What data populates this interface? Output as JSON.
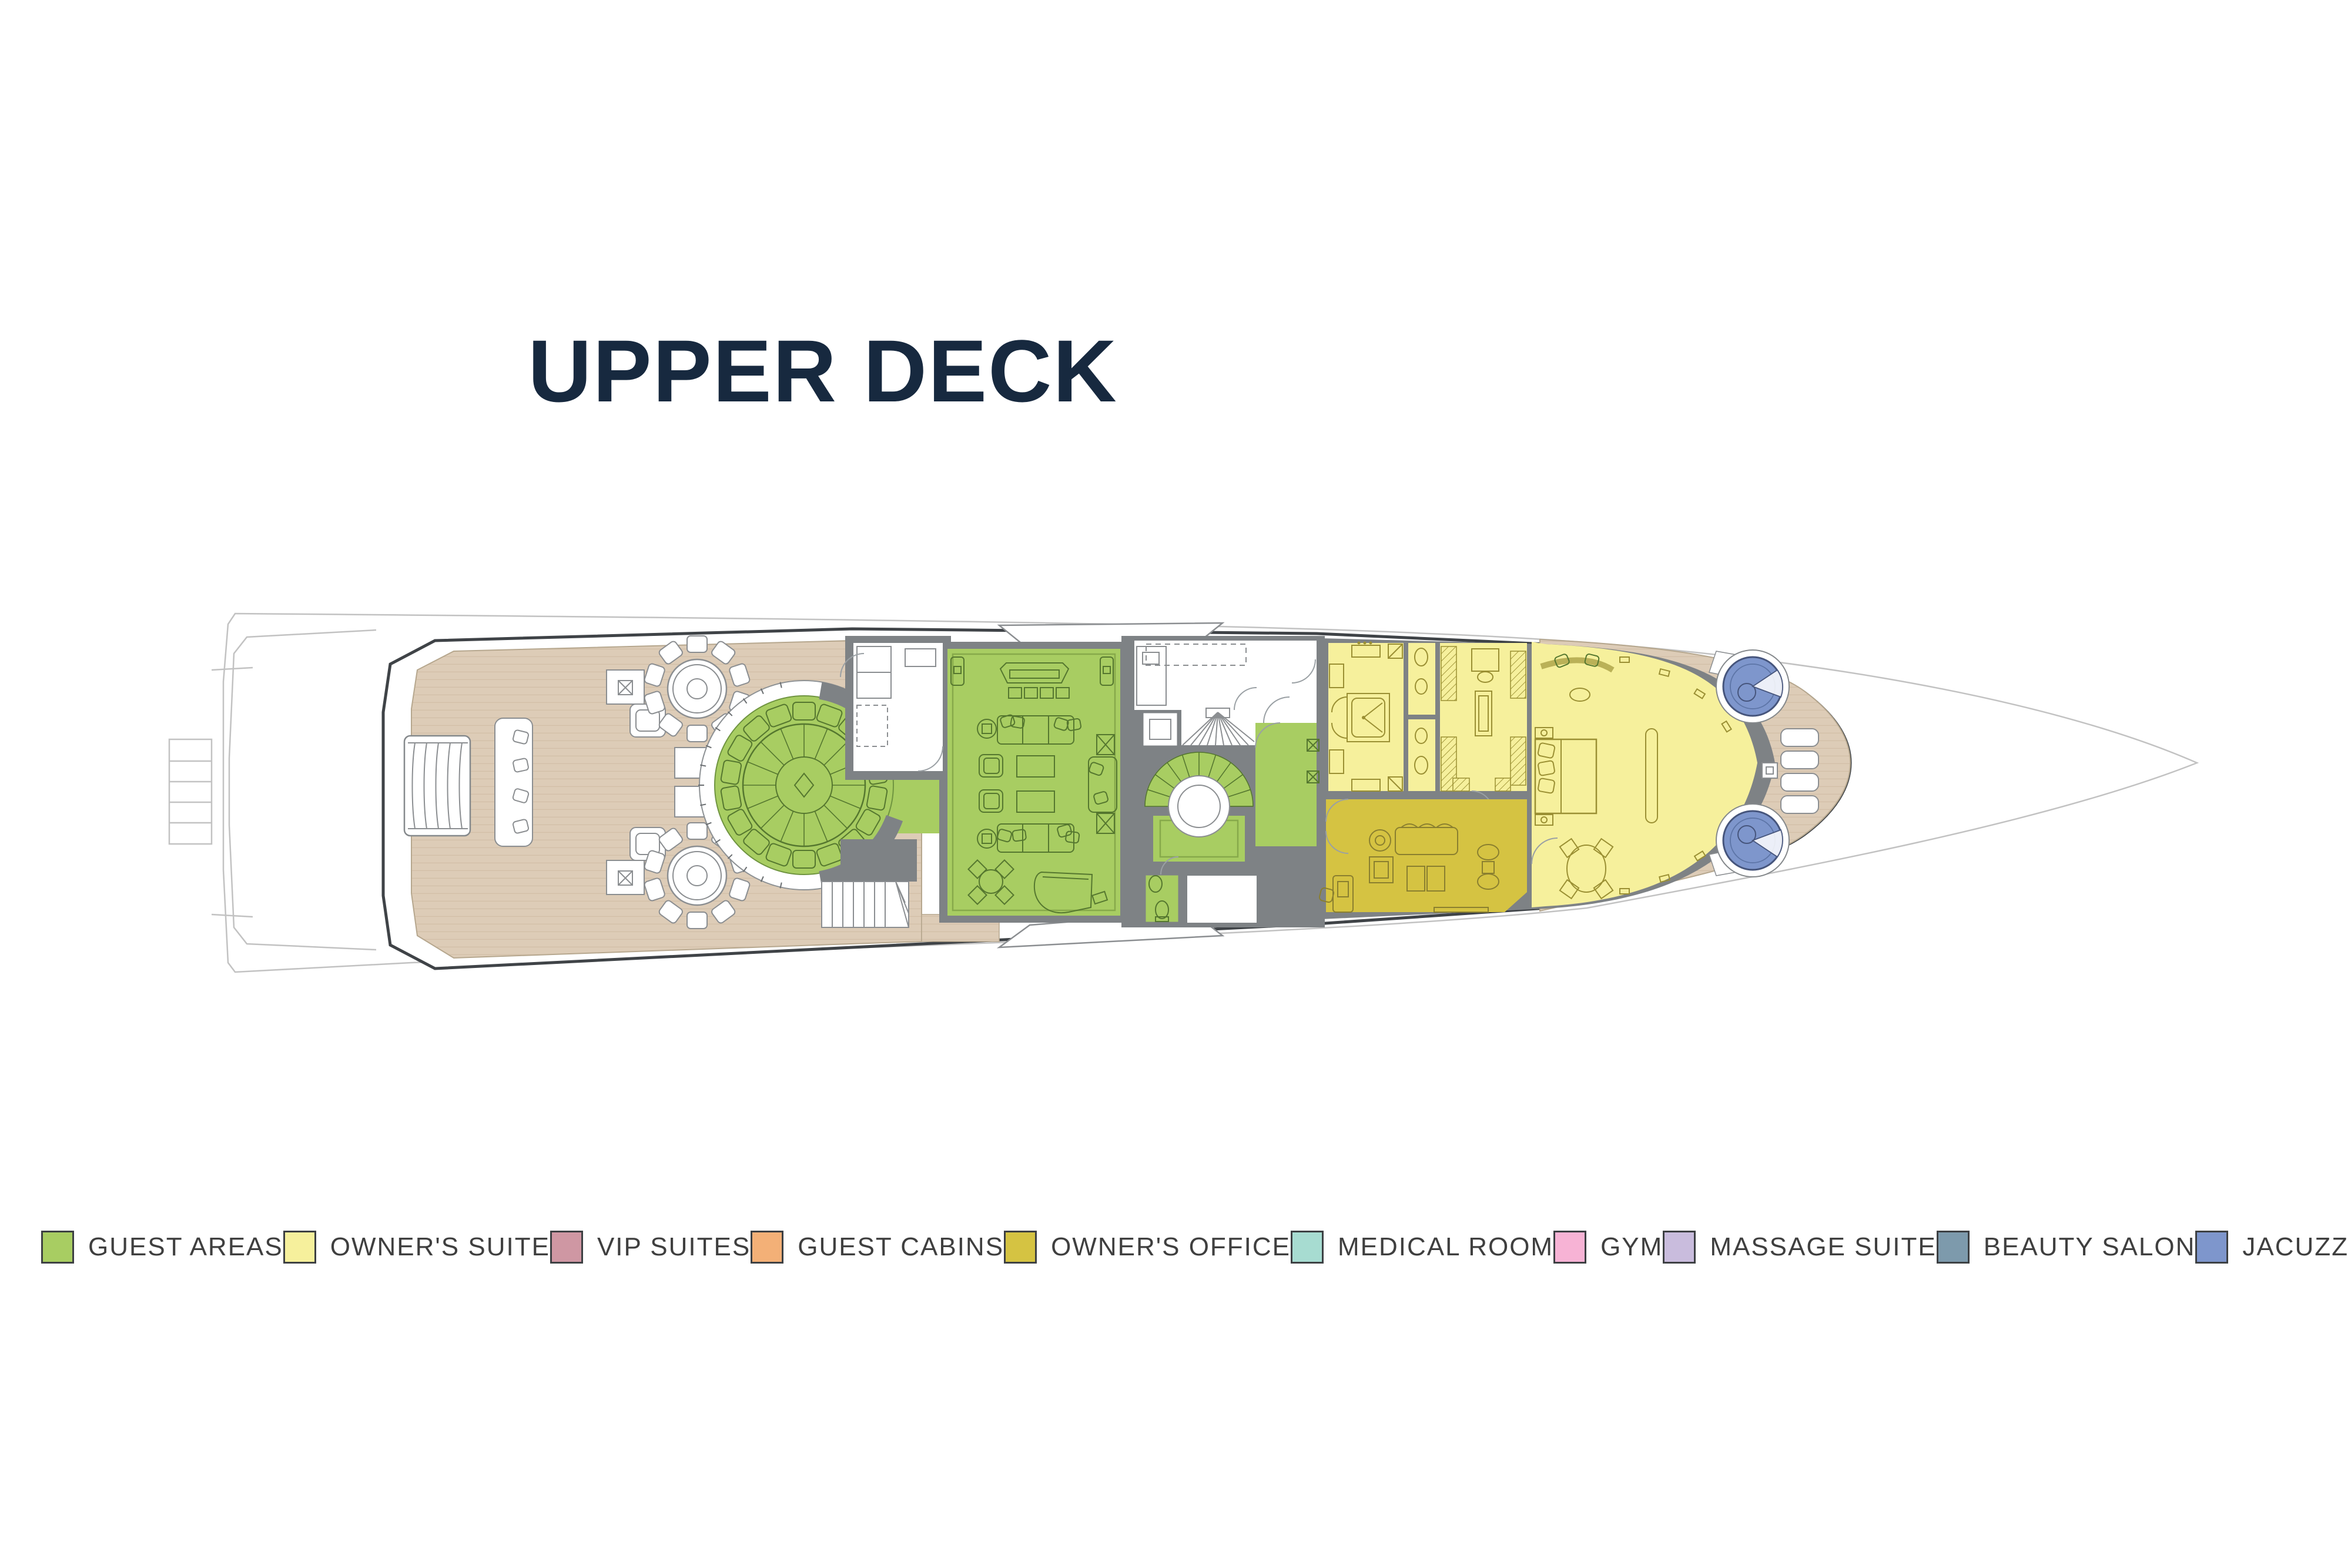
{
  "title": "UPPER DECK",
  "legend": {
    "items": [
      {
        "label": "GUEST AREAS",
        "color": "#a8cd62"
      },
      {
        "label": "OWNER'S SUITE",
        "color": "#f6f09c"
      },
      {
        "label": "VIP SUITES",
        "color": "#cf97a3"
      },
      {
        "label": "GUEST CABINS",
        "color": "#f3b077"
      },
      {
        "label": "OWNER'S OFFICE",
        "color": "#d5c342"
      },
      {
        "label": "MEDICAL ROOM",
        "color": "#a7dcd1"
      },
      {
        "label": "GYM",
        "color": "#f7b3d5"
      },
      {
        "label": "MASSAGE SUITE",
        "color": "#c9bcdd"
      },
      {
        "label": "BEAUTY SALON",
        "color": "#7d9aac"
      },
      {
        "label": "JACUZZI",
        "color": "#7e96cc"
      },
      {
        "label": "POOL",
        "color": "#aedcf2"
      }
    ]
  },
  "colors": {
    "title_navy": "#17293f",
    "guest_green": "#a8cd62",
    "owner_yellow": "#f6f09c",
    "office_olive": "#d5c342",
    "jacuzzi_blue": "#7e96cc",
    "teak": "#ddccb7",
    "teak_line": "#d2bfa7",
    "wall_gray": "#7e8285",
    "outline_dark": "#3f4347",
    "faint_line": "#c2c2c2"
  }
}
